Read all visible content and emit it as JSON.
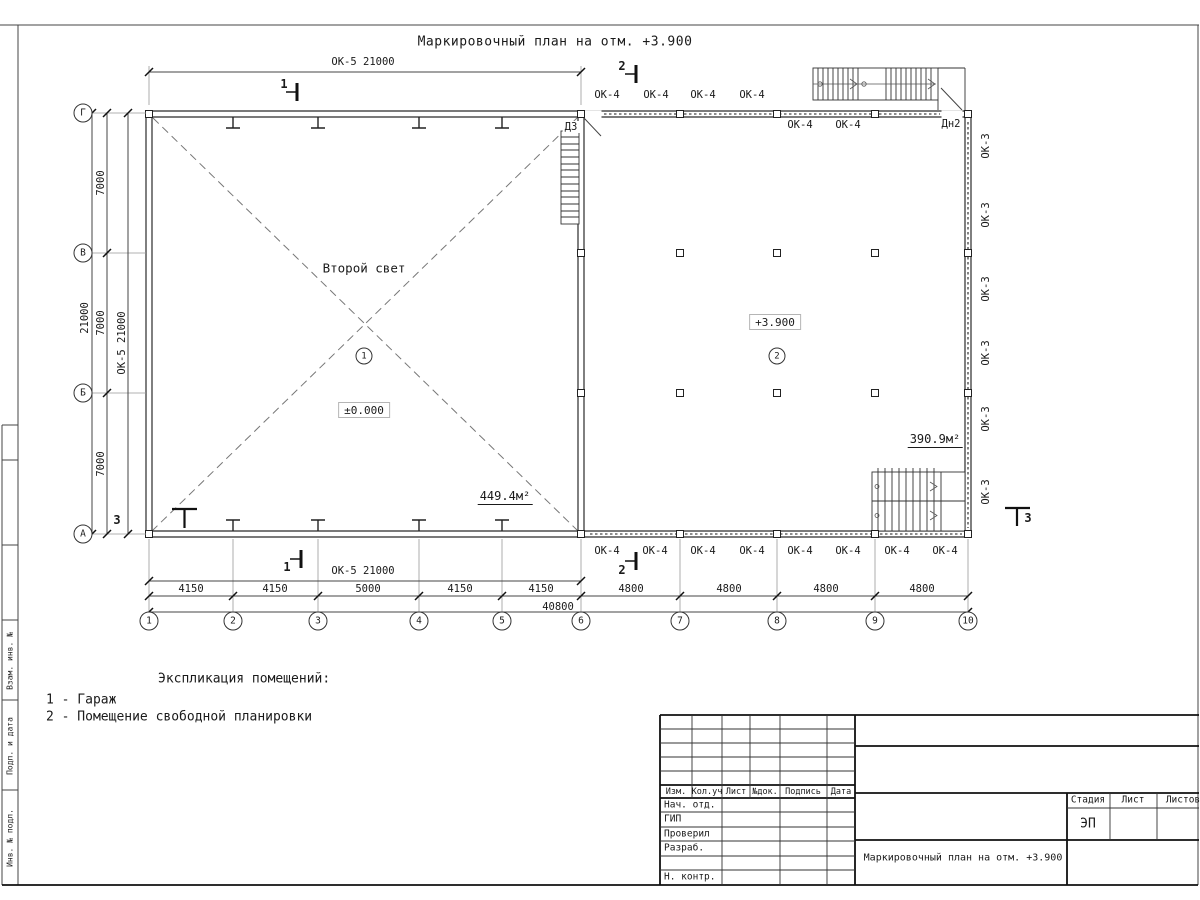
{
  "sheet": {
    "title": "Маркировочный план на отм. +3.900"
  },
  "plan": {
    "room1": {
      "number": "1",
      "second_light": "Второй свет",
      "elevation": "±0.000",
      "area": "449.4м²"
    },
    "room2": {
      "number": "2",
      "elevation": "+3.900",
      "area": "390.9м²"
    },
    "door_top": "Д3",
    "door_right": "Дн2",
    "window_ok4": "ОК-4",
    "window_ok3": "ОК-3"
  },
  "axes": {
    "letters": [
      "Г",
      "В",
      "Б",
      "А"
    ],
    "numbers": [
      "1",
      "2",
      "3",
      "4",
      "5",
      "6",
      "7",
      "8",
      "9",
      "10"
    ]
  },
  "dims": {
    "ok5_21000": "ОК-5 21000",
    "v_total": "21000",
    "v_7000": "7000",
    "h_4150": "4150",
    "h_5000": "5000",
    "h_4800": "4800",
    "h_total": "40800"
  },
  "sections": {
    "s1": "1",
    "s2": "2",
    "s3": "3"
  },
  "legend": {
    "title": "Экспликация помещений:",
    "item1": "1 - Гараж",
    "item2": "2 - Помещение свободной планировки"
  },
  "titleblock": {
    "cols": {
      "izm": "Изм.",
      "kol": "Кол.уч",
      "list": "Лист",
      "doc": "№док.",
      "sign": "Подпись",
      "date": "Дата"
    },
    "rows": {
      "r1": "Нач. отд.",
      "r2": "ГИП",
      "r3": "Проверил",
      "r4": "Разраб.",
      "r6": "Н. контр."
    },
    "stage": {
      "label": "Стадия",
      "list": "Лист",
      "lists": "Листов",
      "value": "ЭП"
    },
    "doc_title": "Маркировочный план на отм. +3.900"
  },
  "stamps": {
    "s1": "Взам. инв. №",
    "s2": "Подп. и дата",
    "s3": "Инв. № подл."
  }
}
